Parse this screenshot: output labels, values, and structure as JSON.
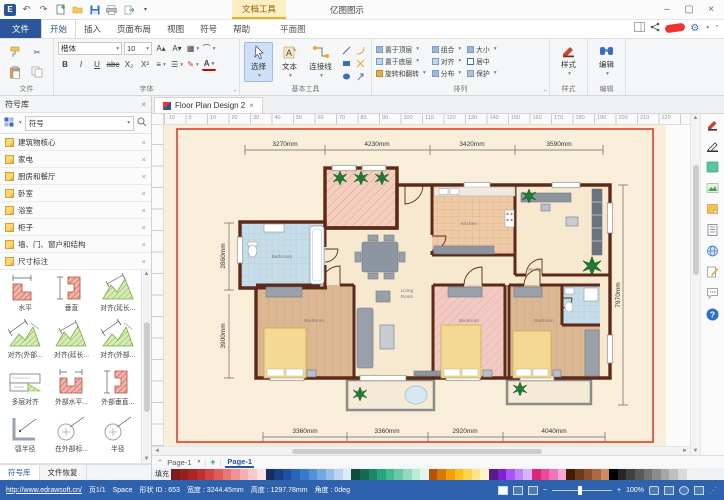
{
  "title_bar": {
    "doc_tools": "文档工具",
    "app_title": "亿图图示"
  },
  "tab_bar": {
    "file": "文件",
    "tabs": [
      "开始",
      "插入",
      "页面布局",
      "视图",
      "符号",
      "帮助"
    ],
    "contextual": "平面图"
  },
  "ribbon": {
    "group_labels": [
      "文件",
      "字体",
      "基本工具",
      "排列",
      "样式",
      "编辑"
    ],
    "font": {
      "family": "楷体",
      "size": "10",
      "bold": "B",
      "italic": "I",
      "underline": "U",
      "strike": "abc",
      "subscript": "X₂",
      "superscript": "X²",
      "color_btn": "A"
    },
    "tools": {
      "select": "选择",
      "text": "文本",
      "connector": "连接线"
    },
    "arrange": [
      "置于顶层",
      "置于底层",
      "旋转和翻转",
      "组合",
      "对齐",
      "分布",
      "大小",
      "居中",
      "保护"
    ],
    "style": "样式",
    "edit": "编辑"
  },
  "symbol_panel": {
    "title": "符号库",
    "search_value": "符号",
    "libraries": [
      "建筑物核心",
      "家电",
      "厨房和餐厅",
      "卧室",
      "浴室",
      "柜子",
      "墙、门、窗户和结构",
      "尺寸标注"
    ],
    "symbols": [
      "水平",
      "垂直",
      "对齐(延长...",
      "对齐(外部...",
      "对齐(延长...",
      "对齐(外部...",
      "多层对齐",
      "外部水平...",
      "外部垂直...",
      "弧半径",
      "在外部标...",
      "半径"
    ],
    "bottom_tabs": [
      "符号库",
      "文件恢复"
    ]
  },
  "document": {
    "tab_title": "Floor Plan Design 2",
    "page_selector": "Page-1",
    "page_tab": "Page-1",
    "fill_label": "填充"
  },
  "ruler_numbers": [
    "-10",
    "0",
    "10",
    "20",
    "30",
    "40",
    "50",
    "60",
    "70",
    "80",
    "90",
    "100",
    "110",
    "120",
    "130",
    "140",
    "150",
    "160",
    "170",
    "180",
    "190",
    "200",
    "210",
    "220"
  ],
  "floor_plan": {
    "dims_top": [
      "3270mm",
      "4230mm",
      "3420mm",
      "3590mm"
    ],
    "dims_bottom": [
      "3360mm",
      "3360mm",
      "2920mm",
      "4040mm"
    ],
    "dims_left": [
      "2860mm",
      "3900mm"
    ],
    "dim_right": "7970mm",
    "rooms": {
      "bathroom": "Bathroom",
      "kitchen": "Kitchen",
      "study": "Study",
      "living_1": "Living",
      "living_2": "Room",
      "bedroom_left": "Bedroom",
      "bedroom_mid": "Bedroom",
      "bedroom_right": "Bedroom"
    }
  },
  "palette": {
    "colors": [
      "#7f1d1d",
      "#951f1f",
      "#ab2727",
      "#c03030",
      "#d04444",
      "#dd5c5c",
      "#e87878",
      "#ef9494",
      "#f5b0b0",
      "#f9caca",
      "#fce3e3",
      "#172d5b",
      "#1c3f7d",
      "#21519e",
      "#2a64ba",
      "#3b78c9",
      "#5590d6",
      "#74a8e0",
      "#97bfe9",
      "#bad5f1",
      "#dcebf8",
      "#0f4d3a",
      "#156a50",
      "#1c8766",
      "#28a37c",
      "#46b891",
      "#6cc9a8",
      "#93dabf",
      "#bcebd7",
      "#e0f6ec",
      "#b45309",
      "#d97706",
      "#f59e0b",
      "#fbbf24",
      "#fcd34d",
      "#fde68a",
      "#fef3c7",
      "#581c87",
      "#7e22ce",
      "#a855f7",
      "#c084fc",
      "#d8b4fe",
      "#db2777",
      "#ec4899",
      "#f472b6",
      "#f9a8d4",
      "#451a03",
      "#6b3a1f",
      "#8c4f2d",
      "#ad6a42",
      "#ce8c63",
      "#000000",
      "#262626",
      "#404040",
      "#595959",
      "#737373",
      "#8c8c8c",
      "#a6a6a6",
      "#bfbfbf",
      "#d9d9d9",
      "#f2f2f2"
    ]
  },
  "status_bar": {
    "url": "http://www.edrawsoft.cn/",
    "page_info": "页1/1",
    "space_label": "Space",
    "shape_id": "形状 ID : 653",
    "width": "宽度 : 3244.45mm",
    "height": "高度 : 1297.78mm",
    "angle": "角度 : 0deg",
    "zoom_level": "100%"
  }
}
